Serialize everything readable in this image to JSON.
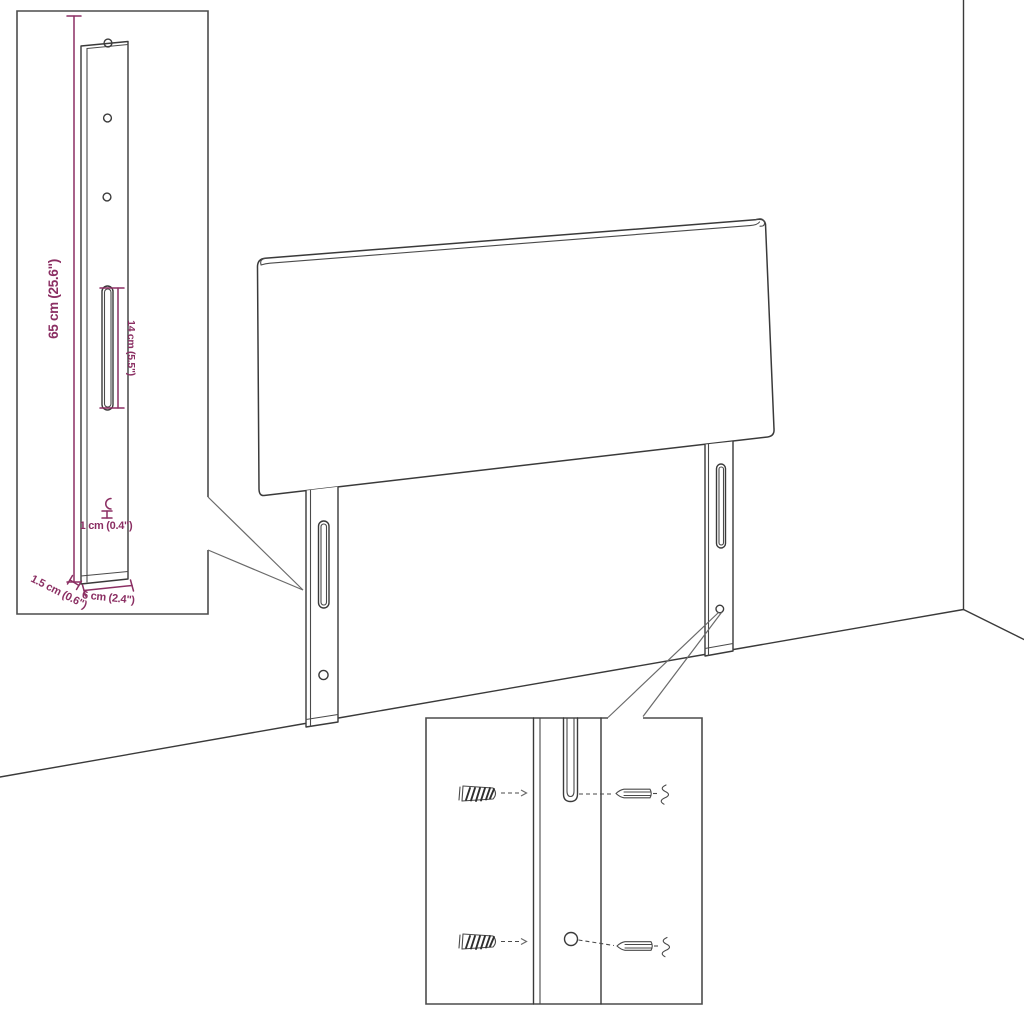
{
  "page": {
    "background_color": "#ffffff",
    "line_color": "#3a3a3a",
    "dimension_color": "#8b2f63"
  },
  "diagram": {
    "labels": {
      "bracket_height": "65 cm (25.6\")",
      "slot_length": "14 cm (5.5\")",
      "hook_thickness": "1 cm (0.4\")",
      "bracket_depth": "1.5 cm (0.6\")",
      "bracket_width": "6 cm (2.4\")"
    },
    "icons": {
      "wall_plug": "wall-plug-icon",
      "screw": "screw-icon",
      "mounting_hole": "mounting-hole",
      "mounting_slot": "mounting-slot"
    }
  }
}
